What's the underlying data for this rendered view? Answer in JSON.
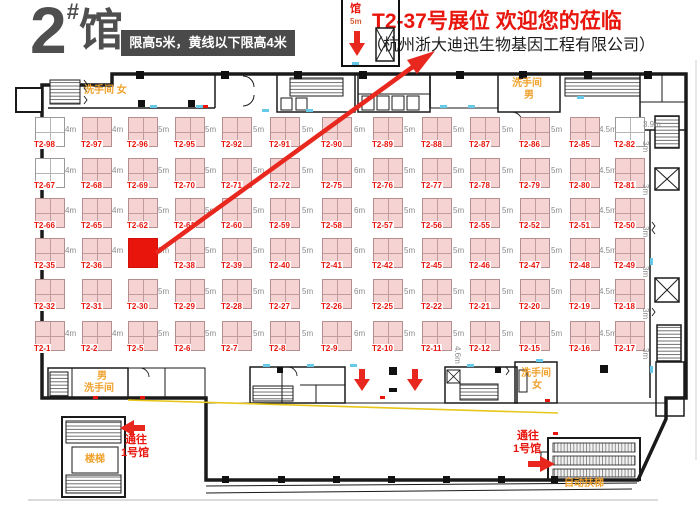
{
  "colors": {
    "accent_red": "#e8150d",
    "orange": "#f0a22e",
    "yellow_line": "#e6c619",
    "wall_black": "#1a1a1a",
    "booth_pink": "#f6d3d3",
    "title_gray": "#4f4f4f"
  },
  "header": {
    "hall_number": "2",
    "hall_hash": "#",
    "hall_word": "馆",
    "height_notice": "限高5米，黄线以下限高4米"
  },
  "annotation": {
    "title": "T2-37号展位 欢迎您的莅临",
    "company": "（杭州浙大迪迅生物基因工程有限公司）",
    "highlighted_booth": "T2-37"
  },
  "entrance": {
    "hall_label": "馆",
    "clearance": "5m"
  },
  "plan_labels": {
    "restroom_women_top": "洗手间 女",
    "restroom_men_top_line1": "洗手间",
    "restroom_men_top_line2": "男",
    "restroom_men_bottom_line1": "男",
    "restroom_men_bottom_line2": "洗手间",
    "restroom_women_bottom_line1": "洗手间",
    "restroom_women_bottom_line2": "女",
    "stairs": "楼梯",
    "escalator": "自动扶梯",
    "to_hall1_line1": "通往",
    "to_hall1_line2": "1号馆"
  },
  "floor": {
    "rows": [
      {
        "booths": [
          {
            "id": "T2-98",
            "type": "white",
            "gap": "4m"
          },
          {
            "id": "T2-97",
            "gap": "4m"
          },
          {
            "id": "T2-96",
            "gap": "5m"
          },
          {
            "id": "T2-95",
            "gap": "5m"
          },
          {
            "id": "T2-92",
            "gap": "5m"
          },
          {
            "id": "T2-91",
            "gap": "5m"
          },
          {
            "id": "T2-90",
            "gap": "6m"
          },
          {
            "id": "T2-89",
            "gap": "5m"
          },
          {
            "id": "T2-88",
            "gap": "5m"
          },
          {
            "id": "T2-87",
            "gap": "5m"
          },
          {
            "id": "T2-86",
            "gap": "5m"
          },
          {
            "id": "T2-85",
            "gap": "4.5m"
          },
          {
            "id": "T2-82",
            "type": "white"
          }
        ]
      },
      {
        "booths": [
          {
            "id": "T2-67",
            "type": "white",
            "gap": "4m"
          },
          {
            "id": "T2-68",
            "gap": "4m"
          },
          {
            "id": "T2-69",
            "gap": "5m"
          },
          {
            "id": "T2-70",
            "gap": "5m"
          },
          {
            "id": "T2-71",
            "gap": "5m"
          },
          {
            "id": "T2-72",
            "gap": "5m"
          },
          {
            "id": "T2-75",
            "gap": "6m"
          },
          {
            "id": "T2-76",
            "gap": "5m"
          },
          {
            "id": "T2-77",
            "gap": "5m"
          },
          {
            "id": "T2-78",
            "gap": "5m"
          },
          {
            "id": "T2-79",
            "gap": "5m"
          },
          {
            "id": "T2-80",
            "gap": "4.5m"
          },
          {
            "id": "T2-81"
          }
        ]
      },
      {
        "booths": [
          {
            "id": "T2-66",
            "gap": "4m"
          },
          {
            "id": "T2-65",
            "gap": "4m"
          },
          {
            "id": "T2-62",
            "gap": "5m"
          },
          {
            "id": "T2-61",
            "gap": "5m"
          },
          {
            "id": "T2-60",
            "gap": "5m"
          },
          {
            "id": "T2-59",
            "gap": "5m"
          },
          {
            "id": "T2-58",
            "gap": "6m"
          },
          {
            "id": "T2-57",
            "gap": "5m"
          },
          {
            "id": "T2-56",
            "gap": "5m"
          },
          {
            "id": "T2-55",
            "gap": "5m"
          },
          {
            "id": "T2-52",
            "gap": "5m"
          },
          {
            "id": "T2-51",
            "gap": "4.5m"
          },
          {
            "id": "T2-50"
          }
        ]
      },
      {
        "booths": [
          {
            "id": "T2-35",
            "gap": "4m"
          },
          {
            "id": "T2-36",
            "gap": "4m"
          },
          {
            "id": "T2-37",
            "type": "red",
            "gap": "5m"
          },
          {
            "id": "T2-38",
            "gap": "5m"
          },
          {
            "id": "T2-39",
            "gap": "5m"
          },
          {
            "id": "T2-40",
            "gap": "5m"
          },
          {
            "id": "T2-41",
            "gap": "6m"
          },
          {
            "id": "T2-42",
            "gap": "5m"
          },
          {
            "id": "T2-45",
            "gap": "5m"
          },
          {
            "id": "T2-46",
            "gap": "5m"
          },
          {
            "id": "T2-47",
            "gap": "5m"
          },
          {
            "id": "T2-48",
            "gap": "4.5m"
          },
          {
            "id": "T2-49"
          }
        ]
      },
      {
        "booths": [
          {
            "id": "T2-32"
          },
          {
            "id": "T2-31"
          },
          {
            "id": "T2-30",
            "gap": "5m"
          },
          {
            "id": "T2-29",
            "gap": "5m"
          },
          {
            "id": "T2-28",
            "gap": "5m"
          },
          {
            "id": "T2-27",
            "gap": "5m"
          },
          {
            "id": "T2-26",
            "gap": "6m"
          },
          {
            "id": "T2-25",
            "gap": "5m"
          },
          {
            "id": "T2-22",
            "gap": "5m"
          },
          {
            "id": "T2-21",
            "gap": "5m"
          },
          {
            "id": "T2-20",
            "gap": "5m"
          },
          {
            "id": "T2-19",
            "gap": "4.5m"
          },
          {
            "id": "T2-18"
          }
        ]
      },
      {
        "booths": [
          {
            "id": "T2-1",
            "gap": "4m"
          },
          {
            "id": "T2-2",
            "gap": "4m"
          },
          {
            "id": "T2-5",
            "gap": "5m"
          },
          {
            "id": "T2-6",
            "gap": "5m"
          },
          {
            "id": "T2-7",
            "gap": "5m"
          },
          {
            "id": "T2-8",
            "gap": "5m"
          },
          {
            "id": "T2-9",
            "gap": "6m"
          },
          {
            "id": "T2-10",
            "gap": "5m"
          },
          {
            "id": "T2-11",
            "gap": "5m"
          },
          {
            "id": "T2-12",
            "gap": "5m"
          },
          {
            "id": "T2-15",
            "gap": "5m"
          },
          {
            "id": "T2-16",
            "gap": "4.5m"
          },
          {
            "id": "T2-17"
          }
        ]
      }
    ],
    "side_labels": [
      {
        "text": "3.9m",
        "x": 643,
        "y": 120,
        "rot": 0
      },
      {
        "text": "3m",
        "x": 650,
        "y": 141,
        "rot": 90
      },
      {
        "text": "3m",
        "x": 650,
        "y": 184,
        "rot": 90
      },
      {
        "text": "3m",
        "x": 650,
        "y": 226,
        "rot": 90
      },
      {
        "text": "3m",
        "x": 650,
        "y": 266,
        "rot": 90
      },
      {
        "text": "3m",
        "x": 650,
        "y": 308,
        "rot": 90
      },
      {
        "text": "3m",
        "x": 650,
        "y": 348,
        "rot": 90
      },
      {
        "text": "4.6m",
        "x": 462,
        "y": 346,
        "rot": 90
      }
    ]
  }
}
